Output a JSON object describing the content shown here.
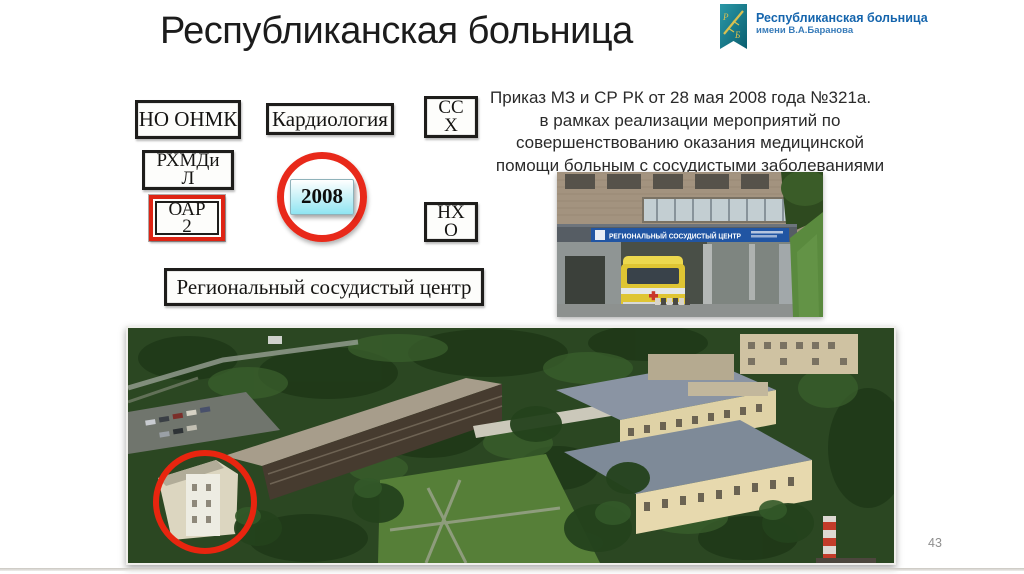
{
  "header": {
    "title": "Республиканская больница",
    "logo": {
      "line1": "Республиканская больница",
      "line2": "имени В.А.Баранова",
      "monogram_p": "Р",
      "monogram_b": "Б",
      "ribbon_color": "#147c8d",
      "text_color": "#1565ad"
    }
  },
  "diagram": {
    "boxes": [
      {
        "id": "no-onmk",
        "label": "НО ОНМК"
      },
      {
        "id": "kardiologia",
        "label": "Кардиология"
      },
      {
        "id": "ssh",
        "label": "СС\nХ"
      },
      {
        "id": "rhmdil",
        "label": "РХМДи\nЛ"
      },
      {
        "id": "oar-2",
        "label": "ОАР\n2",
        "highlighted": true,
        "highlight_color": "#de2414"
      },
      {
        "id": "nho",
        "label": "НХ\nО"
      }
    ],
    "year_badge": {
      "year": "2008",
      "ring_color": "#e8291a",
      "badge_color": "#8fe5f2"
    },
    "result_box": {
      "label": "Региональный сосудистый центр"
    }
  },
  "order": {
    "text": "Приказ МЗ и СР РК от 28 мая 2008 года №321а.     в рамках реализации мероприятий по совершенствованию оказания медицинской помощи больным с сосудистыми заболеваниями"
  },
  "photos": {
    "entrance_sign": "РЕГИОНАЛЬНЫЙ СОСУДИСТЫЙ ЦЕНТР",
    "sign_blue": "#2155a3",
    "annotation_ring_color": "#e8250f"
  },
  "footer": {
    "page_number": "43"
  }
}
